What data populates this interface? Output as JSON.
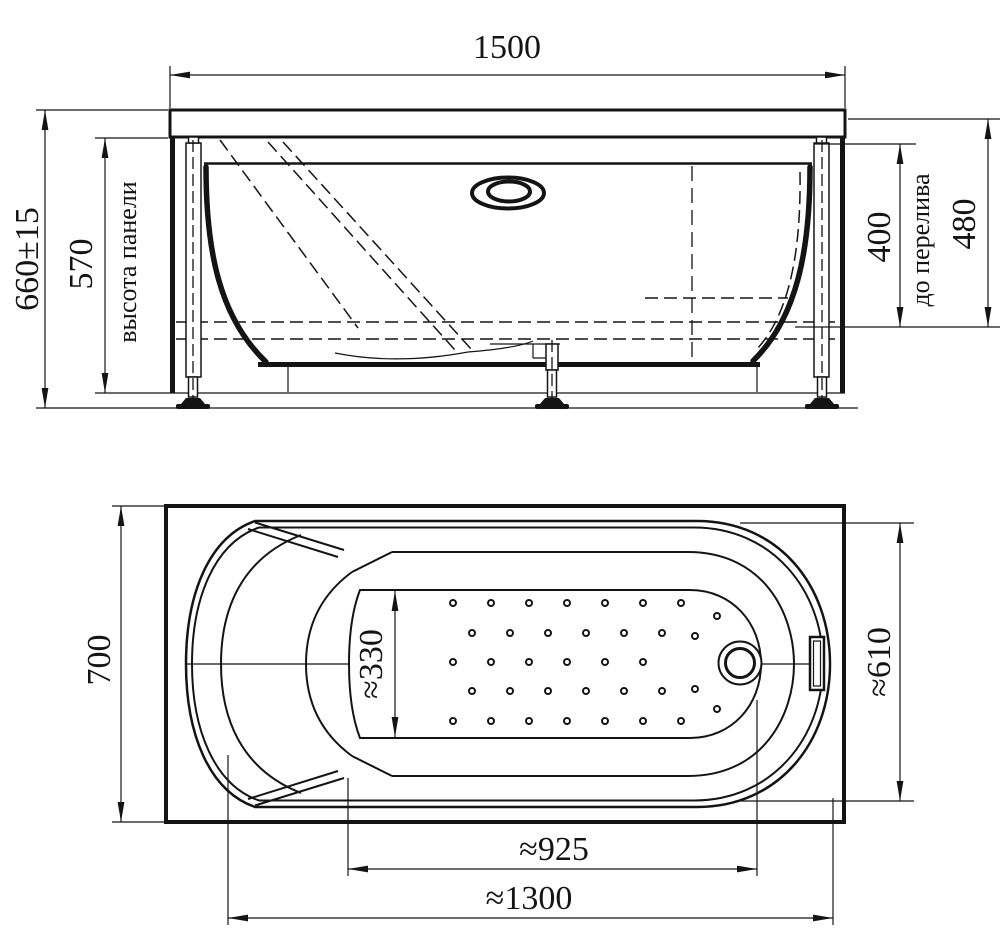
{
  "page": {
    "background": "#ffffff",
    "line_color": "#141414"
  },
  "front_view": {
    "width": "1500",
    "overall_height": "660±15",
    "panel_height": "570",
    "panel_height_label": "высота панели",
    "to_overflow": "400",
    "to_overflow_label": "до перелива",
    "inner_depth": "480"
  },
  "plan_view": {
    "overall_width": "700",
    "floor_width": "≈330",
    "right_inner_width": "≈610",
    "floor_length": "≈925",
    "inner_length": "≈1300"
  }
}
